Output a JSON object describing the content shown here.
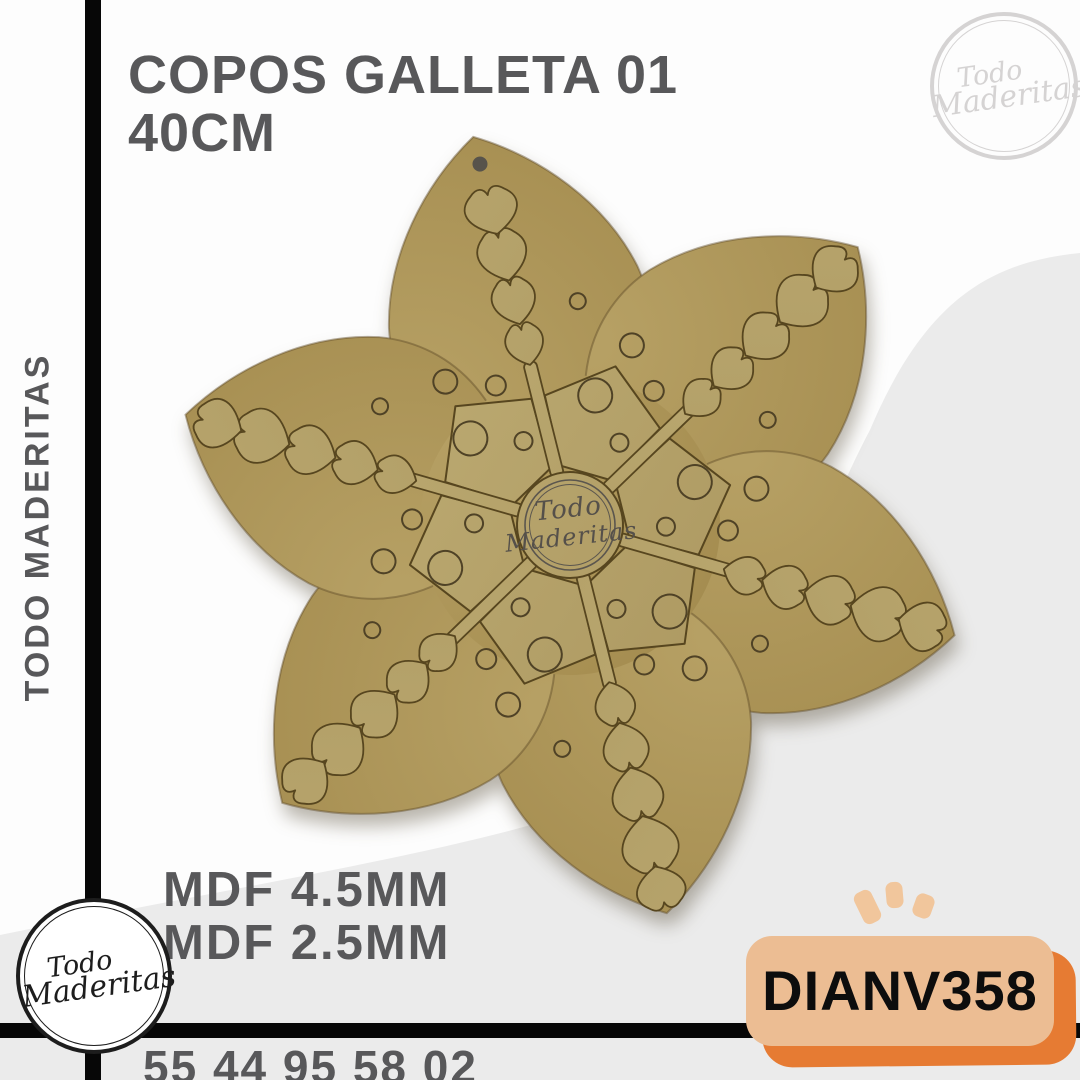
{
  "product": {
    "title_line1": "COPOS GALLETA 01",
    "title_line2": "40CM",
    "material_line1": "MDF 4.5MM",
    "material_line2": "MDF 2.5MM",
    "sku": "DIANV358",
    "phone": "55 44 95 58 02"
  },
  "brand": {
    "name_vertical": "TODO MADERITAS",
    "line1": "Todo",
    "line2": "Maderitas"
  },
  "theme": {
    "bg": "#fdfdfd",
    "swoosh": "#ebebeb",
    "frame_bar": "#070707",
    "text_dark": "#58585a",
    "badge_bg": "#ecbd93",
    "badge_shadow": "#e67b33",
    "badge_text": "#0d0d0d",
    "sparkle": "#f1c69c",
    "logo_light": "#d5d3d3",
    "logo_dark": "#1d1d1d"
  },
  "snowflake": {
    "cx": 570,
    "cy": 525,
    "rotation": -14,
    "petal_path": "M0 -400 C60 -365 112 -305 128 -235 C142 -162 100 -85 0 -55 C-100 -85 -142 -162 -128 -235 C-112 -305 -60 -365 0 -400 Z",
    "petal_stroke": "rgba(95,76,40,0.45)",
    "back_stops": [
      "#b7a165",
      "#a78f52",
      "#8e7843"
    ],
    "front_stops": [
      "#c2b178",
      "#a6915a"
    ],
    "front_edge": "#57461f",
    "engrave": "#4f4226",
    "stem": {
      "inner": 50,
      "outer": 168,
      "width": 13
    },
    "arms": [
      {
        "angle": 0,
        "hearts": [
          [
            165,
            20,
            45
          ],
          [
            207,
            23,
            50
          ],
          [
            252,
            26,
            55
          ],
          [
            300,
            28,
            50
          ]
        ],
        "hole": {
          "r": 372,
          "size": 7.5,
          "fill": "#57534b"
        }
      },
      {
        "angle": 60,
        "hearts": [
          [
            160,
            20,
            44
          ],
          [
            200,
            23,
            48
          ],
          [
            244,
            26,
            53
          ],
          [
            292,
            29,
            58
          ],
          [
            342,
            26,
            50
          ]
        ]
      },
      {
        "angle": 120,
        "hearts": [
          [
            160,
            20,
            44
          ],
          [
            200,
            23,
            48
          ],
          [
            244,
            26,
            53
          ],
          [
            292,
            29,
            58
          ],
          [
            342,
            26,
            50
          ]
        ]
      },
      {
        "angle": 180,
        "hearts": [
          [
            162,
            21,
            46
          ],
          [
            204,
            24,
            51
          ],
          [
            250,
            27,
            56
          ],
          [
            300,
            30,
            60
          ],
          [
            352,
            26,
            46
          ]
        ]
      },
      {
        "angle": 240,
        "hearts": [
          [
            160,
            20,
            44
          ],
          [
            200,
            23,
            48
          ],
          [
            244,
            26,
            53
          ],
          [
            292,
            29,
            58
          ],
          [
            342,
            26,
            50
          ]
        ]
      },
      {
        "angle": 300,
        "hearts": [
          [
            160,
            20,
            44
          ],
          [
            200,
            23,
            48
          ],
          [
            244,
            26,
            53
          ],
          [
            292,
            29,
            58
          ],
          [
            342,
            26,
            50
          ]
        ]
      }
    ],
    "panel_pts": [
      [
        60,
        -25
      ],
      [
        132,
        -27
      ],
      [
        165,
        0
      ],
      [
        132,
        27
      ],
      [
        60,
        25
      ]
    ],
    "sector_circles": [
      [
        96,
        15,
        9
      ],
      [
        132,
        -5,
        17
      ],
      [
        158,
        16,
        10
      ],
      [
        190,
        3,
        12
      ],
      [
        224,
        -14,
        8
      ]
    ],
    "disc_r": 53,
    "watermark": {
      "ring_r": 45,
      "ring_r2": 40.5,
      "ring_color": "#5b564e",
      "text_color": "#55504a"
    }
  }
}
